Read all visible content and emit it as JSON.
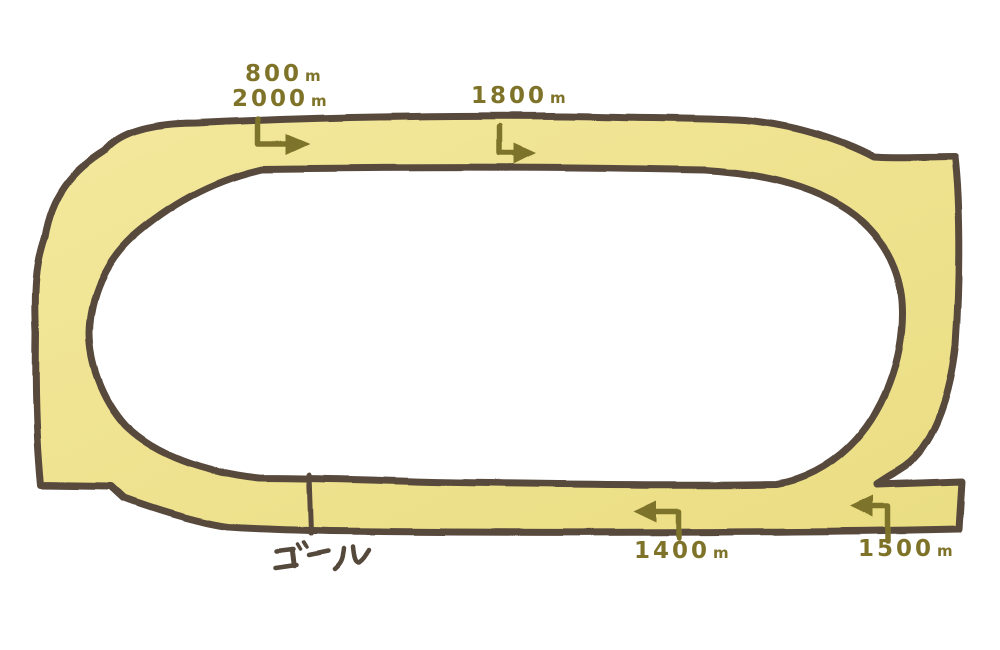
{
  "figure": {
    "type": "racecourse-layout-diagram",
    "background": "#ffffff"
  },
  "track": {
    "surface_light": "#f3e89c",
    "surface_dark": "#eadd83",
    "outline_color": "#584a3d",
    "marker_color": "#7e7329",
    "goal_text_color": "#55483b"
  },
  "markers": [
    {
      "value": "800",
      "unit": "m"
    },
    {
      "value": "2000",
      "unit": "m"
    },
    {
      "value": "1800",
      "unit": "m"
    },
    {
      "value": "1400",
      "unit": "m"
    },
    {
      "value": "1500",
      "unit": "m"
    }
  ],
  "goal": {
    "label": "ゴール"
  }
}
